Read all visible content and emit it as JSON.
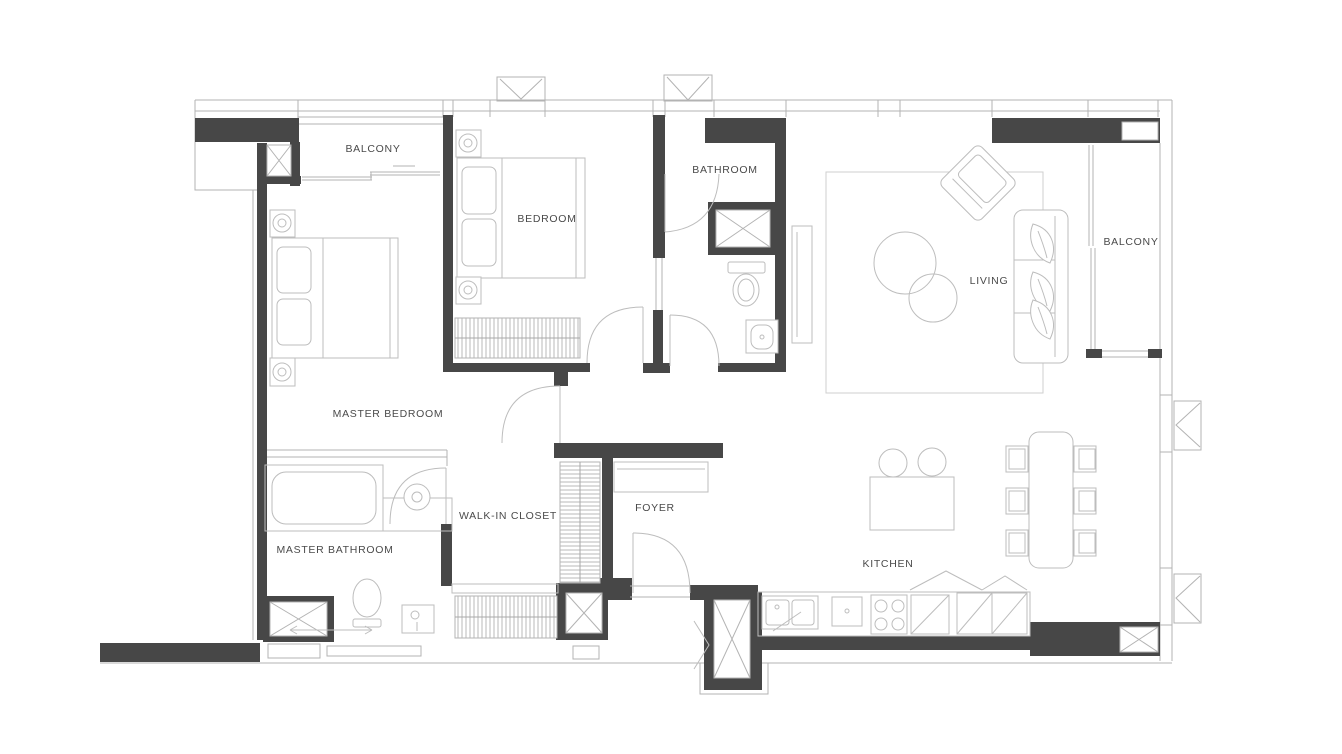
{
  "plan": {
    "colors": {
      "wall": "#474747",
      "line": "#b3b3b3",
      "furniture": "#bdbdbd",
      "label": "#4a4a4a",
      "background": "#ffffff"
    },
    "rooms": [
      {
        "id": "balcony-left",
        "label": "BALCONY"
      },
      {
        "id": "bedroom",
        "label": "BEDROOM"
      },
      {
        "id": "bathroom",
        "label": "BATHROOM"
      },
      {
        "id": "living",
        "label": "LIVING"
      },
      {
        "id": "balcony-right",
        "label": "BALCONY"
      },
      {
        "id": "master-bedroom",
        "label": "MASTER BEDROOM"
      },
      {
        "id": "walk-in-closet",
        "label": "WALK-IN CLOSET"
      },
      {
        "id": "foyer",
        "label": "FOYER"
      },
      {
        "id": "master-bathroom",
        "label": "MASTER BATHROOM"
      },
      {
        "id": "kitchen",
        "label": "KITCHEN"
      }
    ]
  }
}
